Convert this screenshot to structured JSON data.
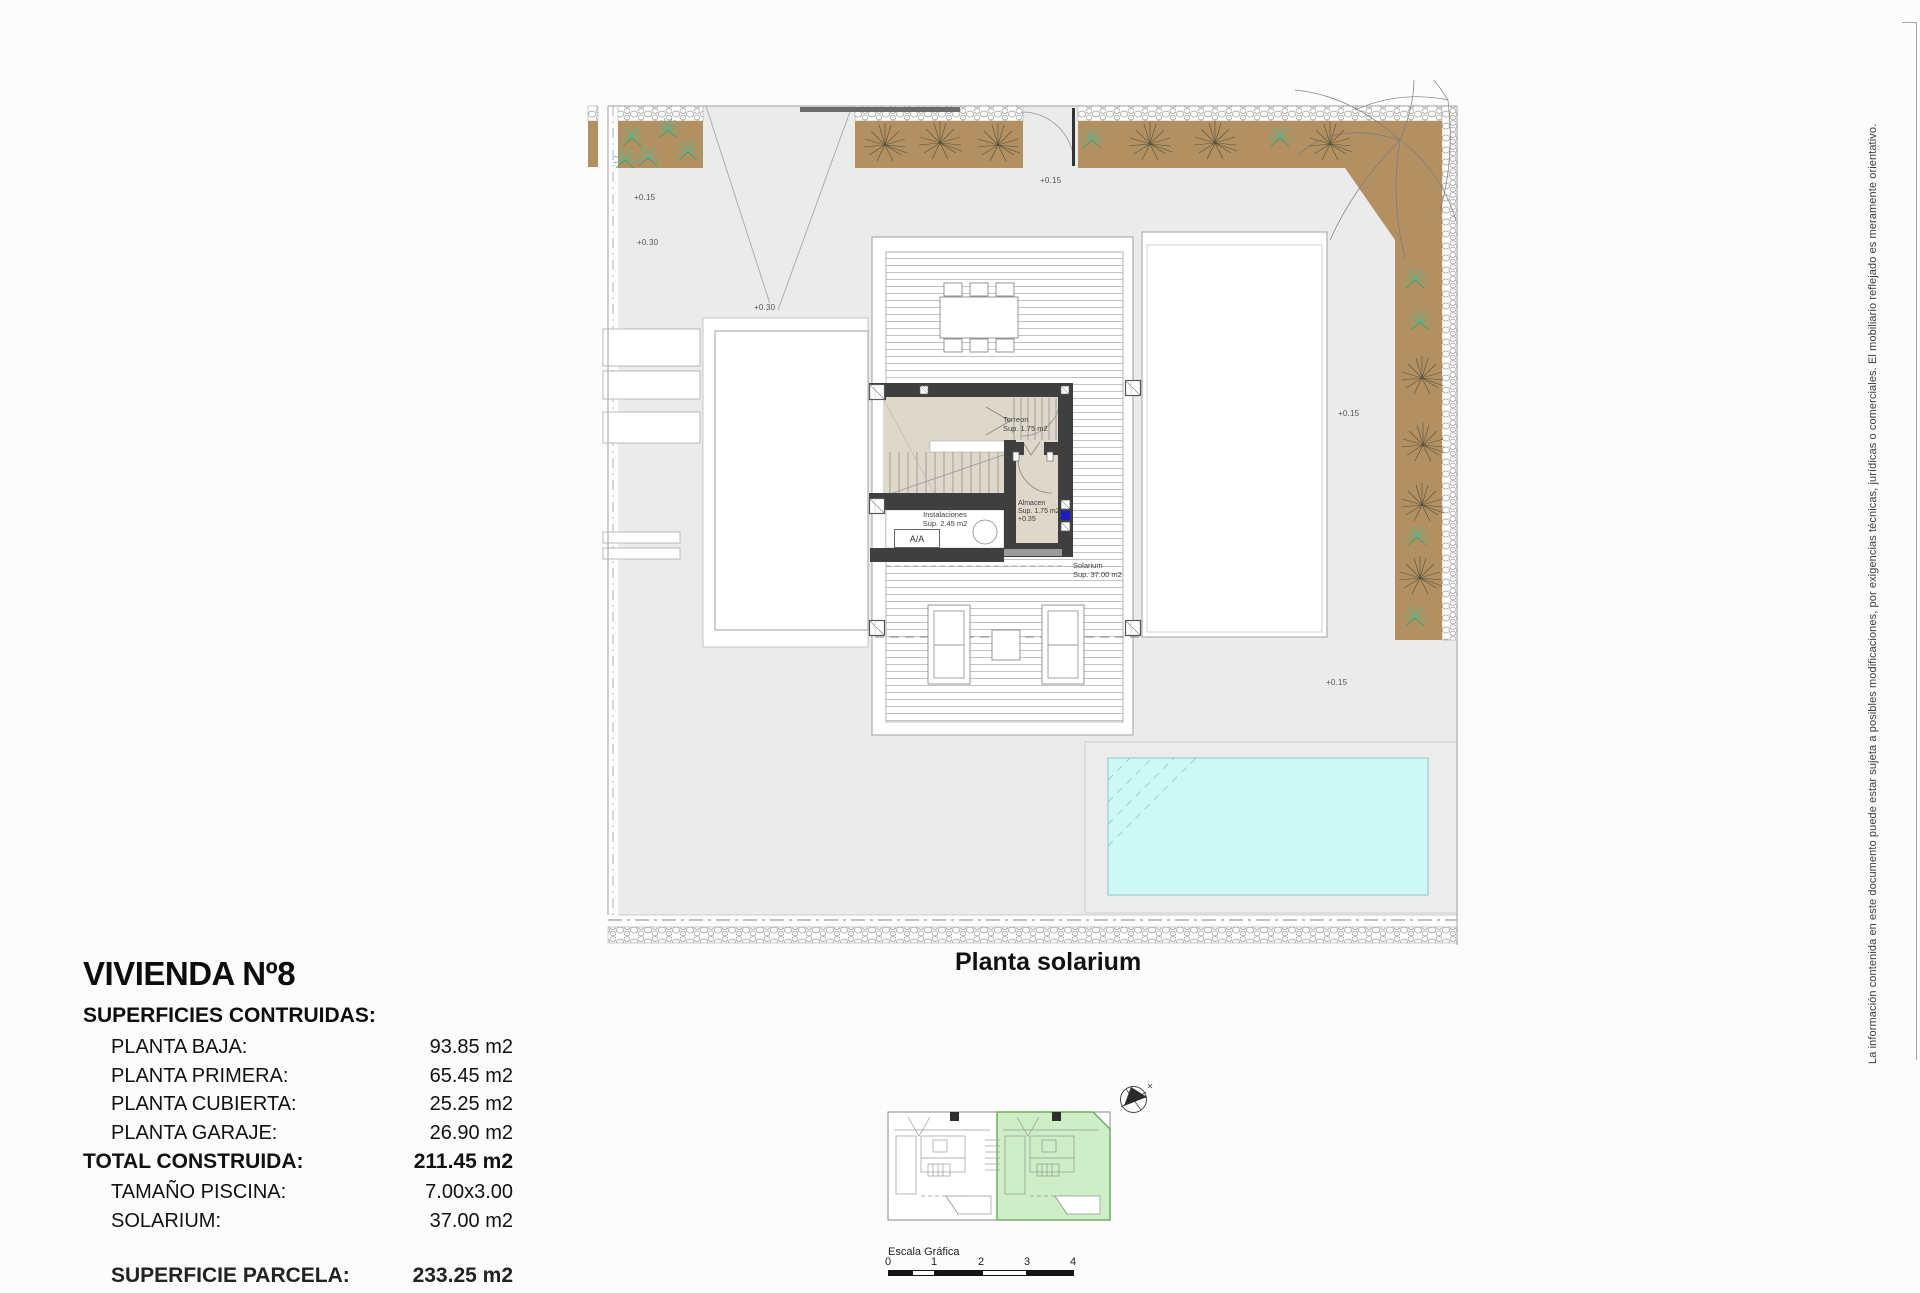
{
  "title_block": {
    "title": "VIVIENDA Nº8",
    "subtitle": "SUPERFICIES CONTRUIDAS:",
    "rows": [
      {
        "label": "PLANTA BAJA:",
        "value": "93.85 m2"
      },
      {
        "label": "PLANTA PRIMERA:",
        "value": "65.45 m2"
      },
      {
        "label": "PLANTA CUBIERTA:",
        "value": "25.25 m2"
      },
      {
        "label": "PLANTA GARAJE:",
        "value": "26.90 m2"
      }
    ],
    "total_row": {
      "label": "TOTAL CONSTRUIDA:",
      "value": "211.45 m2"
    },
    "extra_rows": [
      {
        "label": "TAMAÑO PISCINA:",
        "value": "7.00x3.00"
      },
      {
        "label": "SOLARIUM:",
        "value": "37.00 m2"
      }
    ],
    "clipped_row": {
      "label": "SUPERFICIE PARCELA:",
      "value": "233.25 m2"
    }
  },
  "plan": {
    "caption": "Planta solarium",
    "elevation_marks": [
      "+0.15",
      "+0.30",
      "+0.30",
      "+0.15",
      "+0.15",
      "+0.15"
    ],
    "room_labels": {
      "torreon": {
        "line1": "Torreon",
        "line2": "Sup. 1.75 m2"
      },
      "almacen": {
        "line1": "Almacen",
        "line2": "Sup. 1.75 m2",
        "line3": "+0.35"
      },
      "instalaciones": {
        "line1": "Instalaciones",
        "line2": "Sup. 2.45 m2"
      },
      "aa_unit": "A/A",
      "solarium": {
        "line1": "Solarium",
        "line2": "Sup. 37.00 m2"
      }
    }
  },
  "scale_bar": {
    "label": "Escala Gráfica",
    "ticks": [
      "0",
      "1",
      "2",
      "3",
      "4"
    ]
  },
  "disclaimer": "La información contenida en este documento puede estar sujeta a posibles modificaciones, por exigencias técnicas, jurídicas o comerciales. El mobiliario reflejado es meramente orientativo.",
  "colors": {
    "parcel_gray": "#ebebeb",
    "planting_brown": "#b39062",
    "stair_beige": "#ddd8c9",
    "wall_dark": "#3f3f3f",
    "pool_cyan": "#cdf8f6",
    "keyplan_green": "#cdeec6",
    "window_blue": "#1d1dc8"
  }
}
